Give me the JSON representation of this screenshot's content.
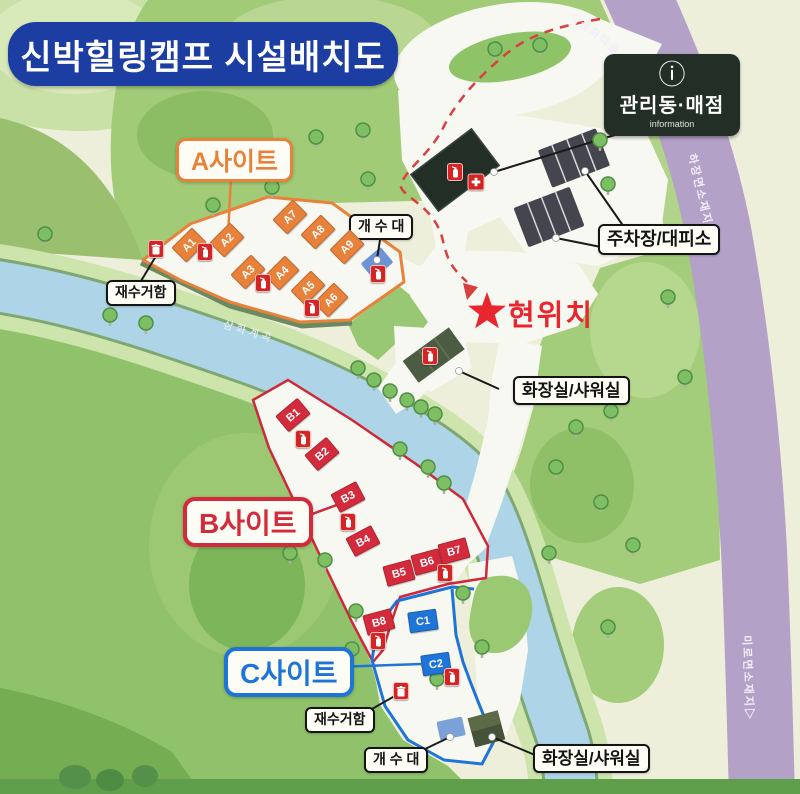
{
  "title": "신박힐링캠프 시설배치도",
  "info_sign": {
    "icon_glyph": "ⓘ",
    "title": "관리동·매점",
    "subtitle": "information"
  },
  "current_location": "현위치",
  "river_label": "삼화계곡",
  "road_labels": {
    "top": "◁삼화마을",
    "right": "하장면소재지▷",
    "bottom": "미로면소재지▷"
  },
  "callouts": {
    "parking": "주차장/대피소",
    "toilet_mid": "화장실/샤워실",
    "toilet_c": "화장실/샤워실",
    "sink_a": "개 수 대",
    "sink_c": "개 수 대",
    "ash_a": "재수거함",
    "ash_c": "재수거함"
  },
  "colors": {
    "title_bg": "#1c3da2",
    "site_a": "#e8813a",
    "site_b": "#d32b3c",
    "site_c": "#1f74d8",
    "road_purple": "#b3a1c7",
    "river_blue": "#aed4e8",
    "star_red": "#e8262e",
    "sign_bg": "#222e26"
  },
  "sites": {
    "a": {
      "label": "A사이트",
      "color": "#e8813a",
      "pads": [
        {
          "id": "A1",
          "x": 189,
          "y": 245,
          "r": -45
        },
        {
          "id": "A2",
          "x": 227,
          "y": 240,
          "r": -45
        },
        {
          "id": "A3",
          "x": 248,
          "y": 272,
          "r": -45
        },
        {
          "id": "A4",
          "x": 282,
          "y": 273,
          "r": -45
        },
        {
          "id": "A5",
          "x": 308,
          "y": 288,
          "r": -45
        },
        {
          "id": "A6",
          "x": 331,
          "y": 300,
          "r": -45
        },
        {
          "id": "A7",
          "x": 290,
          "y": 217,
          "r": -45
        },
        {
          "id": "A8",
          "x": 318,
          "y": 232,
          "r": -45
        },
        {
          "id": "A9",
          "x": 347,
          "y": 247,
          "r": -45
        }
      ]
    },
    "b": {
      "label": "B사이트",
      "color": "#d32b3c",
      "pads": [
        {
          "id": "B1",
          "x": 293,
          "y": 415,
          "r": -40
        },
        {
          "id": "B2",
          "x": 322,
          "y": 454,
          "r": -40
        },
        {
          "id": "B3",
          "x": 348,
          "y": 497,
          "r": -28
        },
        {
          "id": "B4",
          "x": 363,
          "y": 541,
          "r": -28
        },
        {
          "id": "B5",
          "x": 399,
          "y": 573,
          "r": -15
        },
        {
          "id": "B6",
          "x": 427,
          "y": 562,
          "r": -15
        },
        {
          "id": "B7",
          "x": 454,
          "y": 551,
          "r": -15
        },
        {
          "id": "B8",
          "x": 379,
          "y": 622,
          "r": -15
        }
      ]
    },
    "c": {
      "label": "C사이트",
      "color": "#1f74d8",
      "pads": [
        {
          "id": "C1",
          "x": 423,
          "y": 621,
          "r": -8
        },
        {
          "id": "C2",
          "x": 436,
          "y": 664,
          "r": -8
        }
      ]
    }
  },
  "map": {
    "extinguishers": [
      [
        205,
        252
      ],
      [
        263,
        283
      ],
      [
        312,
        308
      ],
      [
        378,
        274
      ],
      [
        455,
        172
      ],
      [
        430,
        356
      ],
      [
        303,
        439
      ],
      [
        348,
        522
      ],
      [
        445,
        573
      ],
      [
        378,
        641
      ],
      [
        452,
        677
      ]
    ],
    "ash_bins": [
      [
        156,
        249
      ],
      [
        401,
        691
      ]
    ],
    "first_aid": [
      476,
      182
    ],
    "trees": [
      [
        245,
        162
      ],
      [
        213,
        208
      ],
      [
        316,
        140
      ],
      [
        363,
        133
      ],
      [
        368,
        182
      ],
      [
        272,
        190
      ],
      [
        45,
        237
      ],
      [
        110,
        318
      ],
      [
        146,
        326
      ],
      [
        358,
        371
      ],
      [
        374,
        383
      ],
      [
        390,
        394
      ],
      [
        407,
        403
      ],
      [
        421,
        410
      ],
      [
        435,
        417
      ],
      [
        400,
        452
      ],
      [
        428,
        470
      ],
      [
        444,
        486
      ],
      [
        600,
        143
      ],
      [
        608,
        187
      ],
      [
        540,
        390
      ],
      [
        576,
        430
      ],
      [
        611,
        414
      ],
      [
        556,
        470
      ],
      [
        601,
        505
      ],
      [
        633,
        548
      ],
      [
        549,
        556
      ],
      [
        608,
        630
      ],
      [
        300,
        511
      ],
      [
        290,
        556
      ],
      [
        325,
        563
      ],
      [
        463,
        596
      ],
      [
        356,
        614
      ],
      [
        352,
        652
      ],
      [
        482,
        650
      ],
      [
        437,
        682
      ],
      [
        495,
        52
      ],
      [
        540,
        48
      ],
      [
        668,
        300
      ],
      [
        685,
        380
      ]
    ]
  }
}
